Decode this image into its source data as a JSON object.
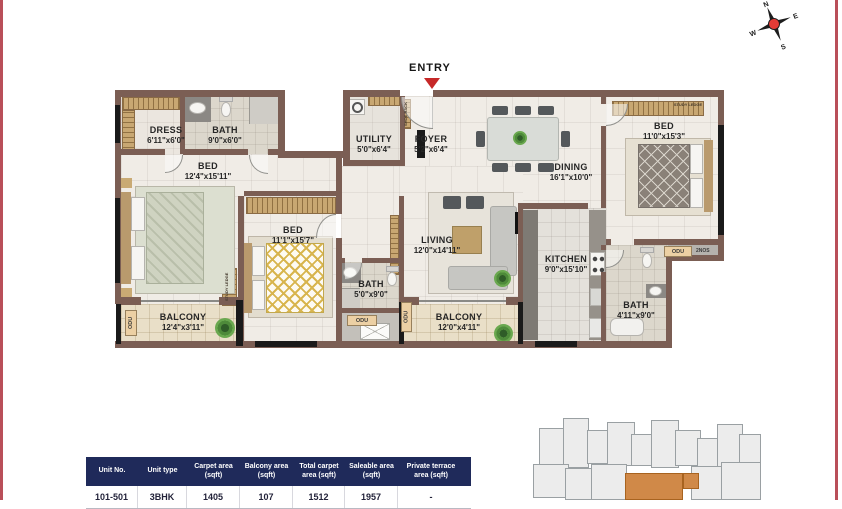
{
  "page": {
    "side_border_color": "#b94f59",
    "background": "#ffffff"
  },
  "entry": {
    "label": "ENTRY",
    "arrow_color": "#c62828"
  },
  "compass": {
    "n": "N",
    "e": "E",
    "s": "S",
    "w": "W",
    "center_color": "#e33b36"
  },
  "plan": {
    "wall_color": "#7b5e54",
    "window_color": "#1a1a1a",
    "rooms": {
      "dress": {
        "name": "DRESS",
        "dims": "6'11\"x6'0\""
      },
      "bath1": {
        "name": "BATH",
        "dims": "9'0\"x6'0\""
      },
      "bed1": {
        "name": "BED",
        "dims": "12'4\"x15'11\""
      },
      "utility": {
        "name": "UTILITY",
        "dims": "5'0\"x6'4\""
      },
      "foyer": {
        "name": "FOYER",
        "dims": "5'2\"x6'4\""
      },
      "dining": {
        "name": "DINING",
        "dims": "16'1\"x10'0\""
      },
      "bed3": {
        "name": "BED",
        "dims": "11'0\"x15'3\""
      },
      "bed2": {
        "name": "BED",
        "dims": "11'1\"x15'7\""
      },
      "living": {
        "name": "LIVING",
        "dims": "12'0\"x14'11\""
      },
      "kitchen": {
        "name": "KITCHEN",
        "dims": "9'0\"x15'10\""
      },
      "bath2": {
        "name": "BATH",
        "dims": "5'0\"x9'0\""
      },
      "bath3": {
        "name": "BATH",
        "dims": "4'11\"x9'0\""
      },
      "balcony1": {
        "name": "BALCONY",
        "dims": "12'4\"x3'11\""
      },
      "balcony2": {
        "name": "BALCONY",
        "dims": "12'0\"x4'11\""
      }
    },
    "annotations": {
      "odu": "ODU",
      "odu_count": "2NOS",
      "shoe_rack": "SHOE RACK",
      "study_ledge": "STUDY LEDGE"
    }
  },
  "table": {
    "header_bg": "#1f2a5a",
    "headers": [
      "Unit No.",
      "Unit type",
      "Carpet area (sqft)",
      "Balcony area (sqft)",
      "Total carpet area (sqft)",
      "Saleable area (sqft)",
      "Private terrace area (sqft)"
    ],
    "rows": [
      [
        "101-501",
        "3BHK",
        "1405",
        "107",
        "1512",
        "1957",
        "-"
      ]
    ]
  },
  "siteplan": {
    "highlight_color": "#d08948"
  }
}
